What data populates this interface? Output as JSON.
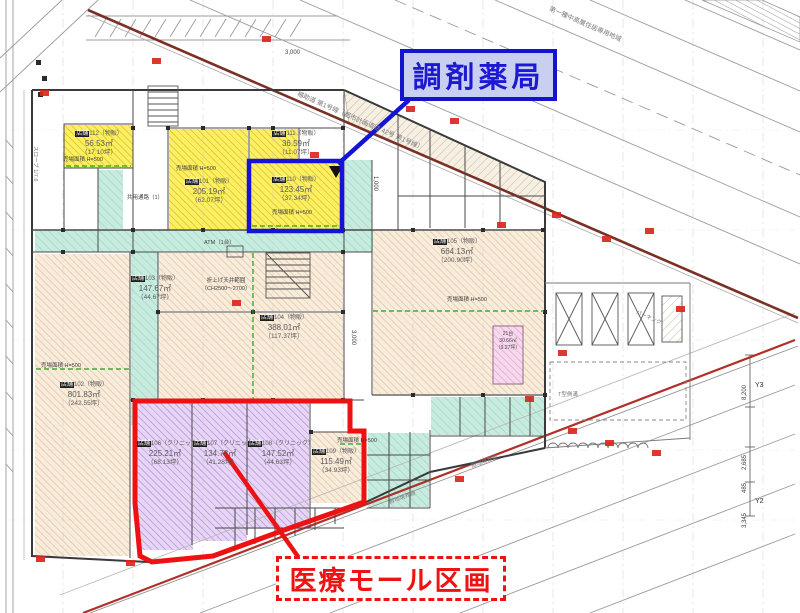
{
  "callouts": {
    "pharmacy": "調剤薬局",
    "medical_mall": "医療モール区画"
  },
  "stores": [
    {
      "prefix": "店舗",
      "label": "101（物販）",
      "area": "205.19㎡",
      "tsubo": "（62.07坪）"
    },
    {
      "prefix": "店舗",
      "label": "102（物販）",
      "area": "801.83㎡",
      "tsubo": "（242.55坪）"
    },
    {
      "prefix": "店舗",
      "label": "103（物販）",
      "area": "147.67㎡",
      "tsubo": "（44.67坪）"
    },
    {
      "prefix": "店舗",
      "label": "104（物販）",
      "area": "388.01㎡",
      "tsubo": "（117.37坪）"
    },
    {
      "prefix": "店舗",
      "label": "105（物販）",
      "area": "664.13㎡",
      "tsubo": "（200.90坪）"
    },
    {
      "prefix": "店舗",
      "label": "106（クリニック）",
      "area": "225.21㎡",
      "tsubo": "（68.13坪）"
    },
    {
      "prefix": "店舗",
      "label": "107（クリニック）",
      "area": "134.78㎡",
      "tsubo": "（41.28坪）"
    },
    {
      "prefix": "店舗",
      "label": "108（クリニック）",
      "area": "147.52㎡",
      "tsubo": "（44.63坪）"
    },
    {
      "prefix": "店舗",
      "label": "109（物販）",
      "area": "115.49㎡",
      "tsubo": "（34.93坪）"
    },
    {
      "prefix": "店舗",
      "label": "110（物販）",
      "area": "123.45㎡",
      "tsubo": "（37.34坪）"
    },
    {
      "prefix": "店舗",
      "label": "111（物販）",
      "area": "36.59㎡",
      "tsubo": "（11.07坪）"
    },
    {
      "prefix": "店舗",
      "label": "112（物販）",
      "area": "56.53㎡",
      "tsubo": "（17.10坪）"
    }
  ],
  "notes": {
    "sales_area": "売場面積 H=500",
    "corridor": "共用通路（1）",
    "atm": "ATM（1台）",
    "ceiling1": "折上げ天井範囲",
    "ceiling2": "（CH2500〜2700）",
    "bike_count": "21台",
    "bike_area": "30.66㎡",
    "bike_tsubo": "（9.27坪）",
    "gutter": "T型側溝",
    "parking": "パーキング",
    "slope": "スロープ 1/7.6",
    "zoning": "第一種中高層住居専用地域",
    "road": "補助道 第1号線（都市計画道路 42号 第1号線）",
    "boundary": "敷地境界線"
  },
  "dims": {
    "d3000": "3,000",
    "d1000": "1,000",
    "d8200": "8,200",
    "d2685": "2,685",
    "d485": "485",
    "d3345": "3,345",
    "y2": "Y2",
    "y3": "Y3"
  },
  "colors": {
    "pharmacy_blue": "#1414cf",
    "mall_red": "#ee1313",
    "retail_yellow": "#fdef62",
    "retail_beige": "#f8ecdc",
    "clinic_purple": "#e6d5f4",
    "corridor_teal": "#c7ecdf",
    "bike_pink": "#f7d9ee"
  }
}
